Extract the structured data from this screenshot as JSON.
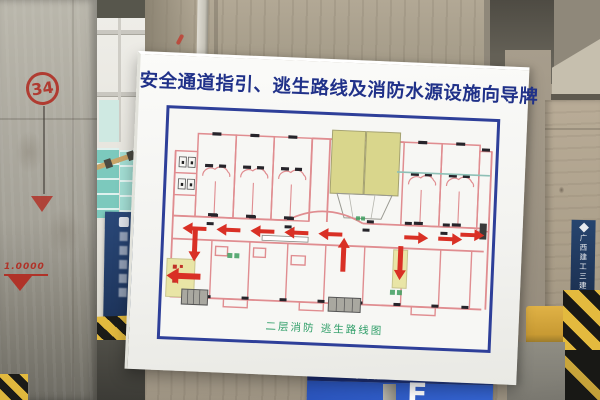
{
  "board": {
    "title": "安全通道指引、逃生路线及消防水源设施向导牌",
    "plan_caption": "二层消防 逃生路线图"
  },
  "left_pillar": {
    "number": "34",
    "elevation_mark": "1.0000"
  },
  "right_banner": {
    "text": "广西建工三建"
  },
  "bottom_sign": {
    "logo_icon": "diamond-logo",
    "company": "广西建工",
    "divider": "|",
    "branch": "三建",
    "zone_glyph": "F"
  },
  "colors": {
    "board_title_blue": "#203189",
    "plan_frame_blue": "#2e3f99",
    "caption_green": "#2f9e68",
    "escape_arrow_red": "#d93025",
    "plan_wall_pink": "#e08d90",
    "plan_highlight_yellow": "#d9d68c",
    "stair_yellow": "#e9e5a6",
    "hazard_yellow": "#e3ba3e",
    "sign_navy": "#1c2c72",
    "sign_blue": "#2b55bd",
    "marking_red": "#b03228"
  }
}
